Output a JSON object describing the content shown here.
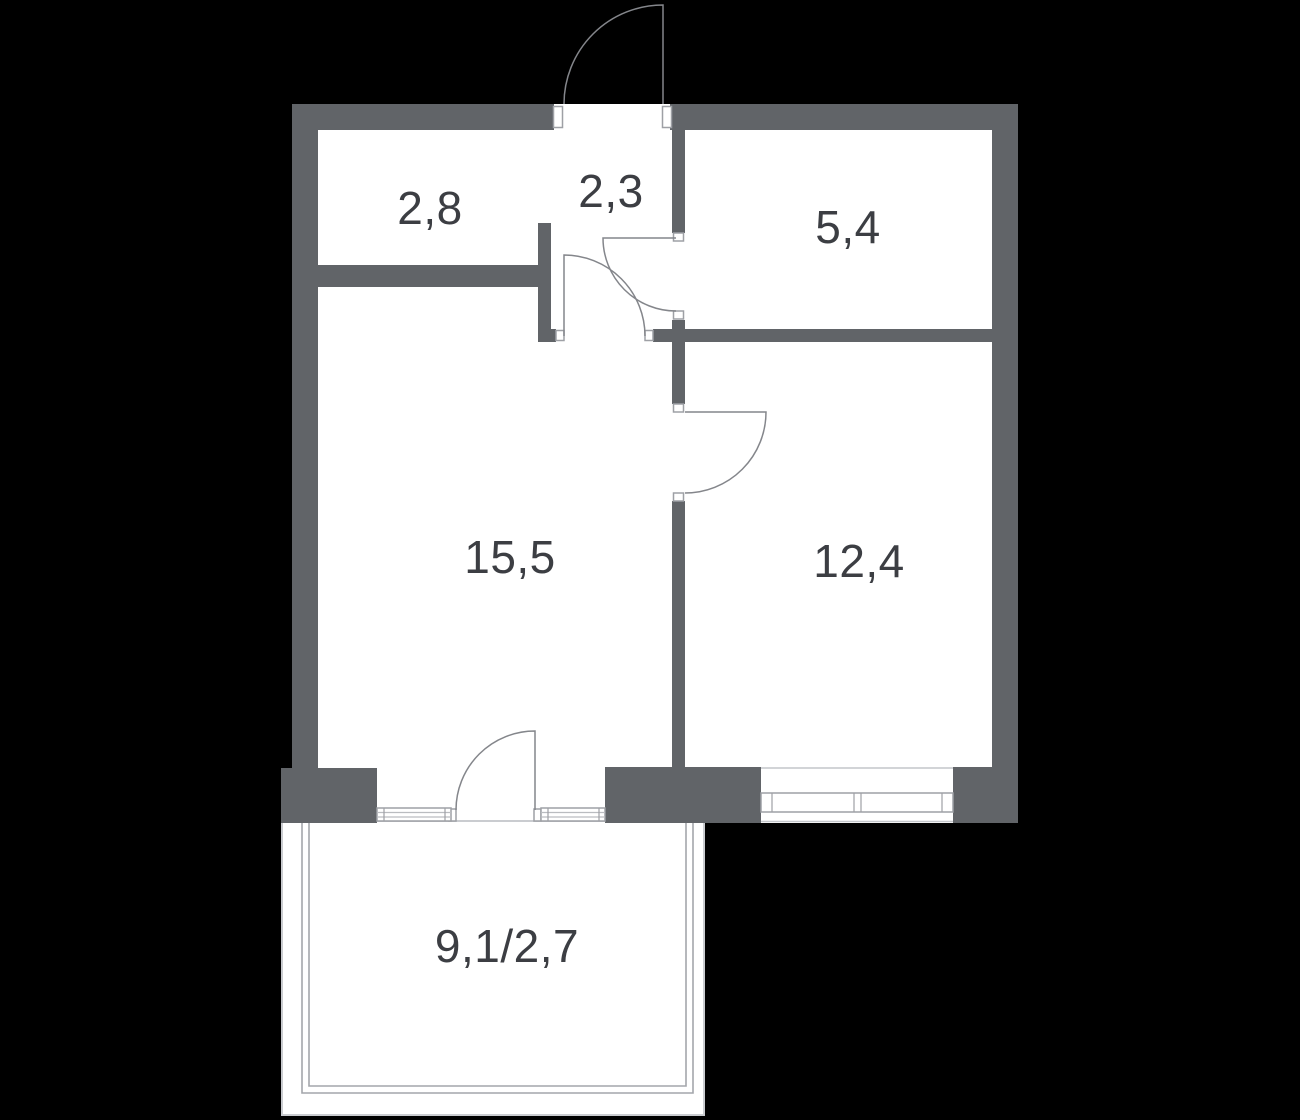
{
  "plan": {
    "type": "apartment-floor-plan",
    "rooms": [
      {
        "id": "wardrobe",
        "area": "2,8"
      },
      {
        "id": "hallway",
        "area": "2,3"
      },
      {
        "id": "bathroom",
        "area": "5,4"
      },
      {
        "id": "living-room",
        "area": "15,5"
      },
      {
        "id": "bedroom",
        "area": "12,4"
      },
      {
        "id": "balcony",
        "area": "9,1/2,7"
      }
    ],
    "colors": {
      "background": "#000000",
      "floor": "#ffffff",
      "wall": "#616468",
      "door_line": "#84868b",
      "window_line": "#9ea0a5",
      "window_inner_line": "#babcc0",
      "balcony_outline": "#caccd0",
      "balcony_glazing": "#a4a6ab",
      "label_text": "#3c3e43"
    },
    "features": {
      "doors": 5,
      "windows": 3,
      "balcony_glazed": true
    }
  }
}
